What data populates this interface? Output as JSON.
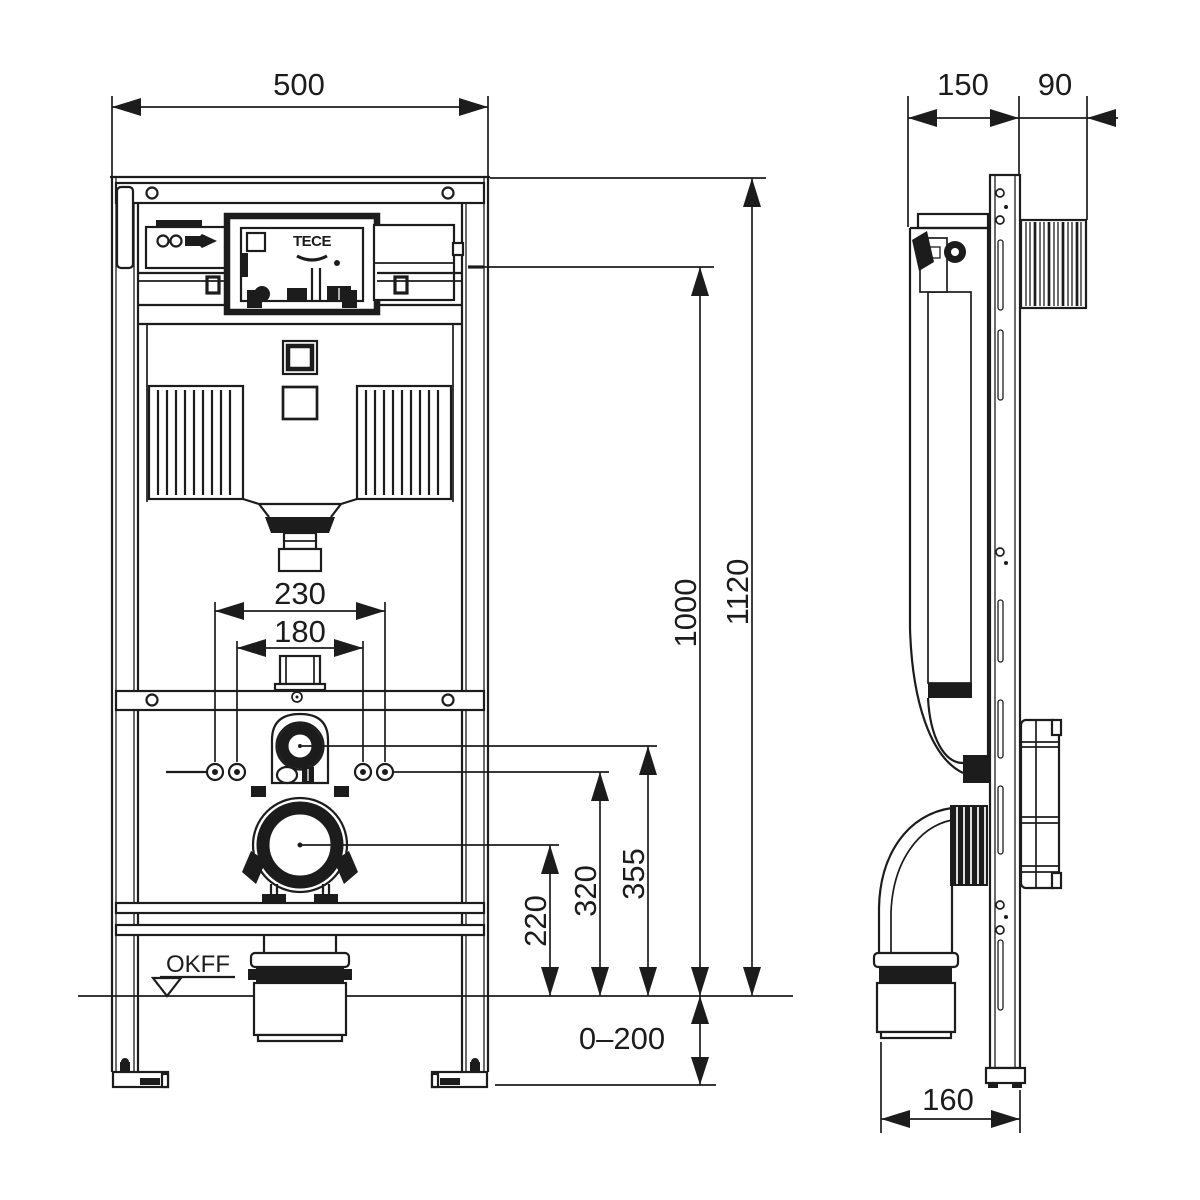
{
  "colors": {
    "line": "#1c1c1c",
    "background": "#ffffff"
  },
  "front_view": {
    "labels": {
      "width": "500",
      "total_height": "1120",
      "upper_edge_height": "1000",
      "flush_connection_height": "355",
      "fixing_bolt_height": "320",
      "outlet_height": "220",
      "fixing_spacing_outer": "230",
      "fixing_spacing_inner": "180",
      "foot_adjustment_range": "0–200",
      "floor_level_marker": "OKFF",
      "brand": "TECE"
    }
  },
  "side_view": {
    "labels": {
      "frame_depth": "150",
      "actuator_depth": "90",
      "outlet_wall_distance": "160"
    }
  }
}
